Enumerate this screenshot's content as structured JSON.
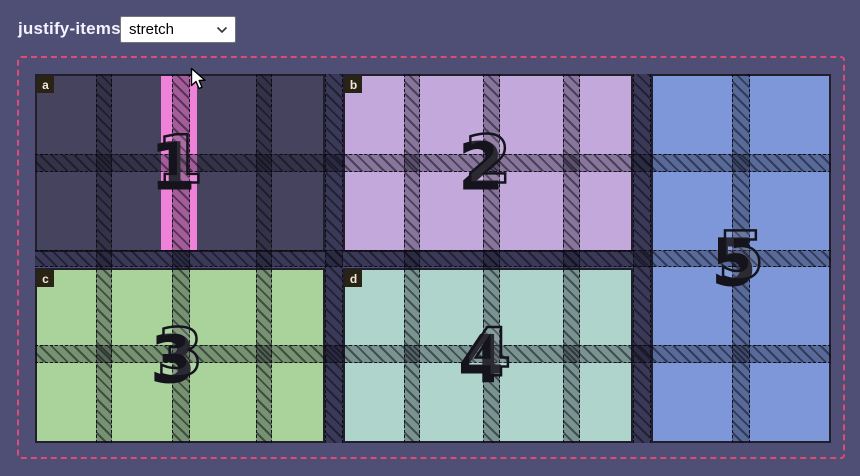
{
  "header": {
    "property_label": "justify-items",
    "select_value": "stretch"
  },
  "colors": {
    "page_bg": "#4f4e75",
    "container_border": "#df4a77",
    "item_border": "#211f2b",
    "item_a_bg": "#46435f",
    "item_b_bg": "#c3a8dc",
    "item_c_bg": "#aad39b",
    "item_d_bg": "#aed4cb",
    "item_e_bg": "#7d97d9",
    "stripe_pink": "#ee82d8",
    "badge_bg": "#292313",
    "numeral_ink": "#15141c"
  },
  "grid": {
    "items": [
      {
        "label": "a",
        "number": "1"
      },
      {
        "label": "b",
        "number": "2"
      },
      {
        "label": "c",
        "number": "3"
      },
      {
        "label": "d",
        "number": "4"
      },
      {
        "label": "",
        "number": "5"
      }
    ]
  }
}
